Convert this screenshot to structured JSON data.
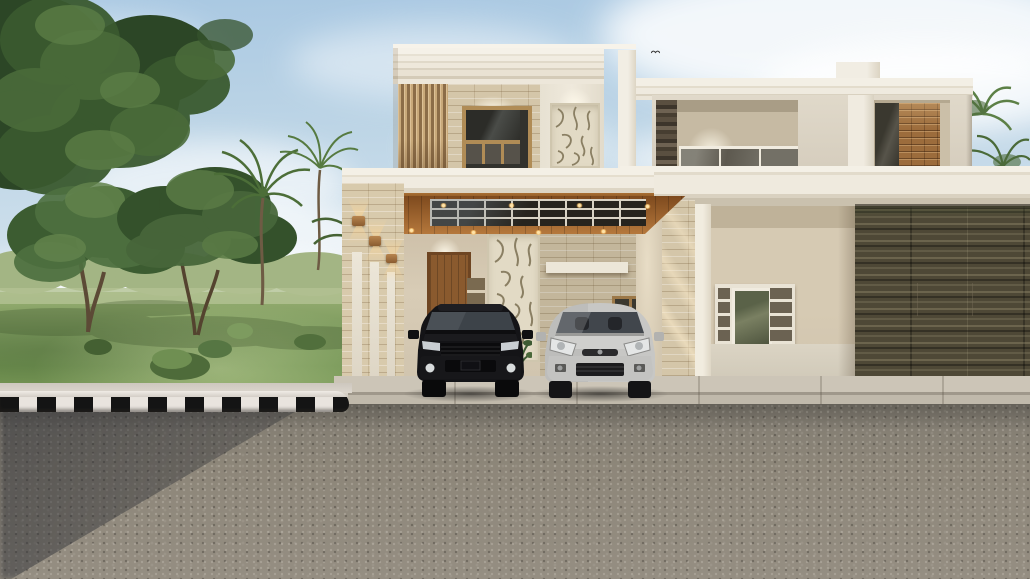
{
  "scene": {
    "type": "architectural-exterior-render",
    "subject": "modern two-storey house with carport, two parked cars, park with trees, striped kerb and asphalt road",
    "text_visible": "none"
  },
  "palette": {
    "sky_top": "#a9c8e2",
    "sky_mid": "#cfe0ec",
    "sky_horizon": "#eef1f1",
    "cloud": "#ffffff",
    "foliage_dark": "#2c4626",
    "foliage_mid": "#47663a",
    "foliage_light": "#62834c",
    "foliage_distant": "#a3b584",
    "grass": "#7d9b5e",
    "grass_light": "#97ae72",
    "wall_cream": "#ece6d9",
    "wall_bright": "#f3efe5",
    "wall_shadow": "#c9bda6",
    "stone_tile": "#d4c6a9",
    "slat_wood": "#c9a97a",
    "ceiling_wood": "#a96f33",
    "door_wood": "#8a5a2e",
    "carve_bg": "#e2dac5",
    "carve_line": "#8a7f63",
    "brick": "#9c6c3c",
    "dark_stone": "#4f4638",
    "olive_tile": "#4e4836",
    "olive_band": "#ded6c4",
    "frame_wood": "#b08c56",
    "curb_black": "#141414",
    "curb_white": "#e9e4de",
    "concrete": "#c6bfb1",
    "road": "#8b8478",
    "road_shadow": "#5a5a58",
    "suv_black": "#17171a",
    "sedan_silver": "#c7c7c5",
    "glow": "#ffe2a6"
  },
  "objects": [
    {
      "name": "sky",
      "label": "daytime sky with scattered clouds"
    },
    {
      "name": "bird",
      "label": "small bird in flight"
    },
    {
      "name": "park",
      "label": "lawn with deciduous and palm trees"
    },
    {
      "name": "house-left-tower",
      "label": "two-storey block with slat panel, stone wall, window, carved panel"
    },
    {
      "name": "carport",
      "label": "carport with wooden ceiling, skylight grid, downlights, entrance door"
    },
    {
      "name": "house-right-wing",
      "label": "upper terrace with glass railing, brick accents, open porch, olive tile wall"
    },
    {
      "name": "suv-black",
      "label": "black SUV parked under carport"
    },
    {
      "name": "sedan-silver",
      "label": "silver hatchback parked under carport"
    },
    {
      "name": "striped-curb",
      "label": "black and white striped kerb"
    },
    {
      "name": "road",
      "label": "asphalt road with tree shadow"
    }
  ]
}
